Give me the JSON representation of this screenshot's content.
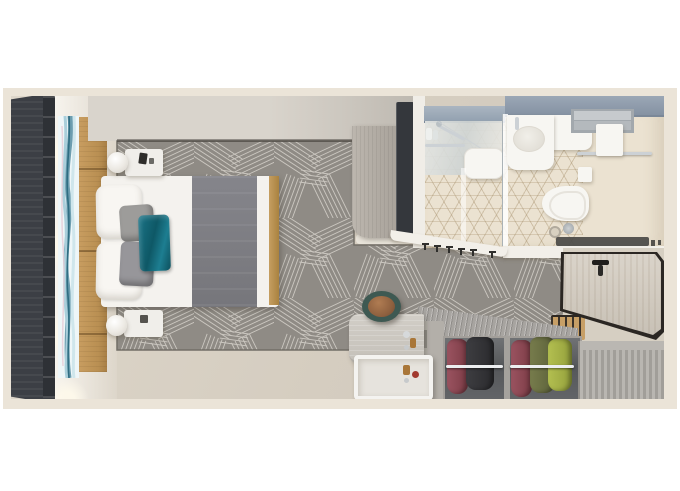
{
  "scene": {
    "label": "Cruise cabin stateroom floor plan (top-down 3D render)",
    "view": "top-down",
    "rooms": {
      "bedroom": {
        "label": "Bedroom",
        "items": [
          "queen-bed",
          "white-pillows",
          "gray-pillows",
          "teal-accent-pillow",
          "gray-bed-runner",
          "nightstand-with-lamp-top",
          "nightstand-with-lamp-bottom",
          "wood-headboard-wall",
          "agate-art-panel",
          "floor-to-ceiling-window",
          "patterned-carpet",
          "wardrobe-tower",
          "wall-mounted-tv"
        ]
      },
      "bathroom": {
        "label": "Bathroom",
        "items": [
          "vanity-counter",
          "sink-basin",
          "faucet",
          "shower-enclosure",
          "shower-seat",
          "glass-partition",
          "toilet",
          "toilet-paper-holder",
          "towel-shelf",
          "towel-bar",
          "hanging-towel",
          "floor-drain",
          "bath-mat",
          "hex-tile-floor"
        ]
      },
      "entry": {
        "label": "Entry",
        "items": [
          "open-cabin-door",
          "door-handle",
          "coat-hooks",
          "entry-bench"
        ]
      },
      "wardrobe": {
        "label": "Wardrobe / desk area",
        "items": [
          "open-closet-clothes",
          "closet-rod",
          "slatted-cabinet",
          "desk",
          "tray-table",
          "round-stool",
          "toiletry-bottles"
        ]
      }
    }
  },
  "palette": {
    "page_bg": "#ffffff",
    "wall_cream": "#ebe4d8",
    "floor_greige": "#d5cdc0",
    "window_dark": "#3c3f45",
    "wood_headboard": "#c0975c",
    "wall_band": "#d3cec6",
    "carpet_base": "#8f8b85",
    "carpet_line": "#d7d3cc",
    "bed_white": "#f4f2ee",
    "runner_gray": "#7f7f83",
    "pillow_gray": "#9b9a98",
    "pillow_teal": "#1a6e7f",
    "bath_counter_blue": "#8fa0b0",
    "bath_floor": "#ebe2d1",
    "tile_line": "#a8926e",
    "fixture_white": "#f7f6f2",
    "cabinet_gray": "#b5afa7",
    "tv_dark": "#34373c",
    "closet_gray": "#a7a4a0",
    "closet_interior": "#5a5c5e",
    "cloth_maroon": "#8d4752",
    "cloth_dark": "#36363a",
    "cloth_olive": "#6d7244",
    "cloth_lime": "#a7b347",
    "door_wood": "#d6d0c6",
    "door_edge": "#2b2723",
    "stool_teal": "#3e5952",
    "stool_leather": "#8d5f3e",
    "mat_dark": "#4a4946",
    "chrome": "#ccd1d5"
  }
}
